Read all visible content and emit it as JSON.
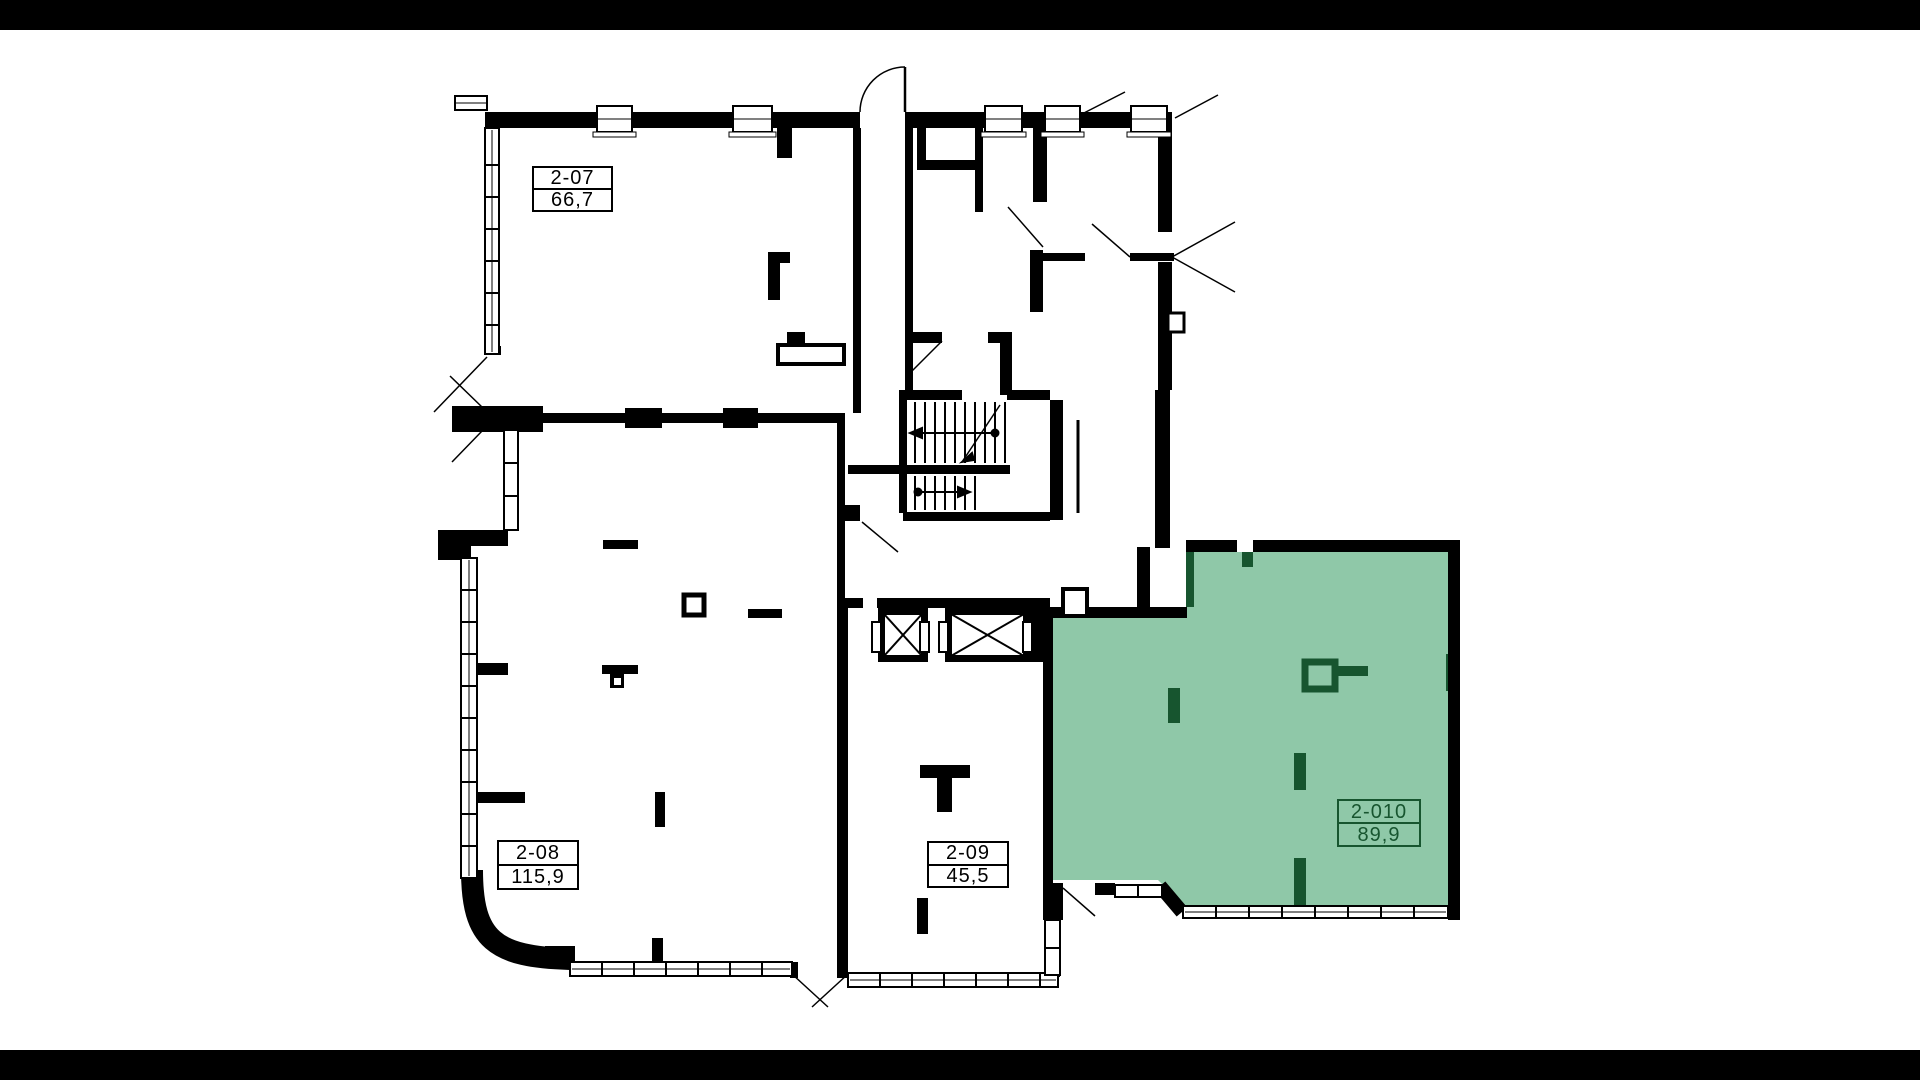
{
  "floor_plan": {
    "units": [
      {
        "id": "2-07",
        "area": "66,7",
        "highlighted": false
      },
      {
        "id": "2-08",
        "area": "115,9",
        "highlighted": false
      },
      {
        "id": "2-09",
        "area": "45,5",
        "highlighted": false
      },
      {
        "id": "2-010",
        "area": "89,9",
        "highlighted": true
      }
    ],
    "colors": {
      "highlight_fill": "#8fc8a8",
      "highlight_accent": "#17552f",
      "walls": "#000000",
      "canvas": "#ffffff",
      "letterbox": "#000000"
    }
  }
}
